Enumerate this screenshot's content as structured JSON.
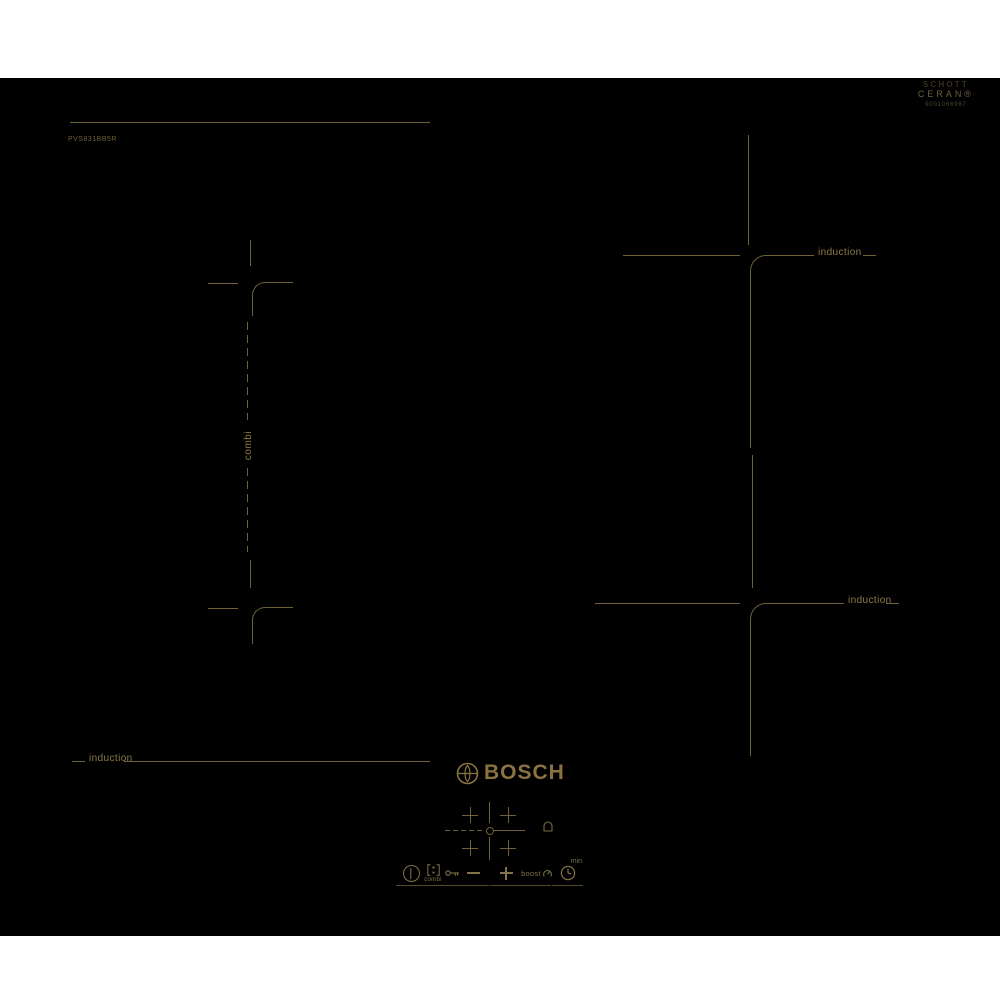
{
  "branding": {
    "schott_brand": "SCHOTT",
    "schott_product": "CERAN®",
    "schott_code": "9001066987",
    "model": "PVS831BB5R",
    "logo_text": "BOSCH"
  },
  "zones": {
    "induction_label": "induction",
    "combi_label": "combi"
  },
  "control_panel": {
    "combi_button_label": "combi",
    "boost_label": "boost",
    "timer_unit_label": "min",
    "icons": {
      "power": "power-icon",
      "combi": "combi-bridge-icon",
      "child_lock": "key-icon",
      "minus": "minus-icon",
      "plus": "plus-icon",
      "boost": "boost-gauge-icon",
      "timer": "clock-icon",
      "alarm": "bell-icon",
      "zone_select": "plus-mark-icon",
      "logo": "bosch-anchor-icon"
    }
  },
  "colors": {
    "surface": "#000000",
    "page_background": "#ffffff",
    "marking_line": "#6f6138",
    "marking_text": "#8d7c4a",
    "logo_gold": "#8a7340"
  }
}
